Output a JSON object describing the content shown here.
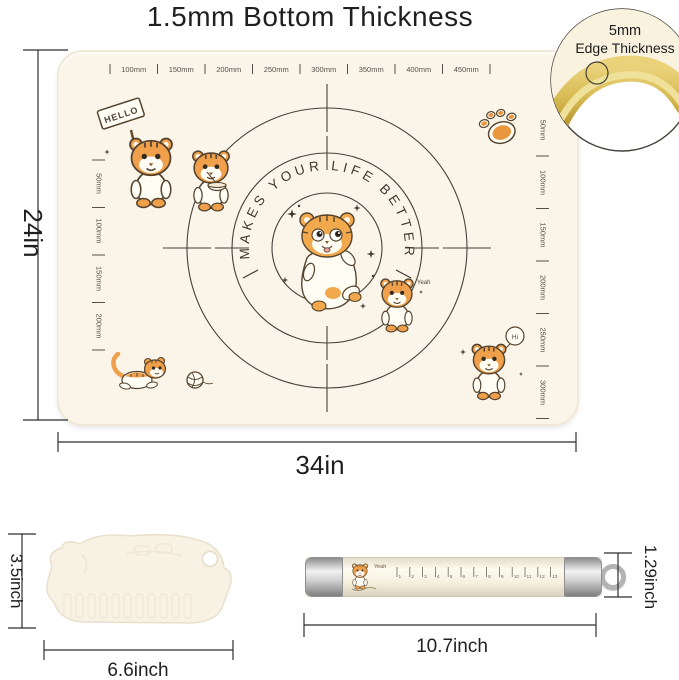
{
  "title": "1.5mm Bottom Thickness",
  "inset": {
    "line1": "5mm",
    "line2": "Edge Thickness"
  },
  "mat": {
    "slogan": "MAKES YOUR LIFE BETTER",
    "top_ruler": [
      "100mm",
      "150mm",
      "200mm",
      "250mm",
      "300mm",
      "350mm",
      "400mm",
      "450mm"
    ],
    "left_ruler": [
      "50mm",
      "100mm",
      "150mm",
      "200mm"
    ],
    "right_ruler": [
      "50mm",
      "100mm",
      "150mm",
      "200mm",
      "250mm",
      "300mm"
    ],
    "hello_sign": "HELLO",
    "yeah_text": "Yeah",
    "hi_text": "Hi"
  },
  "dimensions": {
    "mat_width": "34in",
    "mat_height": "24in",
    "scraper_height": "3.5inch",
    "scraper_width": "6.6inch",
    "pin_height": "1.29inch",
    "pin_length": "10.7inch"
  },
  "rolling_pin": {
    "decal_text": "Yeah",
    "ruler_numbers": [
      "1",
      "2",
      "3",
      "4",
      "5",
      "6",
      "7",
      "8",
      "9",
      "10",
      "11",
      "12",
      "13"
    ]
  },
  "colors": {
    "mat": "#FAF5E8",
    "tiger_orange": "#F0A04B",
    "print_line": "#45413A",
    "edge_gold": "#D9BC55",
    "dim_line": "#2E2E2E"
  }
}
